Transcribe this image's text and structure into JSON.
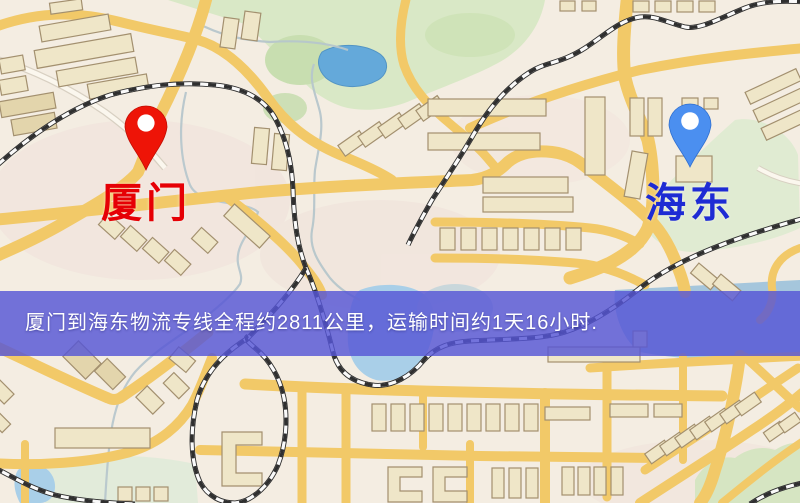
{
  "map": {
    "origin": {
      "label": "厦门",
      "pin_color": "#ee1407",
      "pin_edge": "#c00d02",
      "label_color": "#e60005"
    },
    "destination": {
      "label": "海东",
      "pin_color": "#4b8ff0",
      "pin_edge": "#2f6fd0",
      "label_color": "#1e2bd4"
    },
    "banner": {
      "text": "厦门到海东物流专线全程约2811公里，运输时间约1天16小时.",
      "distance_text": "约2811公里",
      "duration_text": "约1天16小时",
      "background": "#5555d6",
      "text_color": "#ffffff"
    },
    "colors": {
      "map_background": "#f4ede2",
      "road": "#f2c968",
      "building": "#efe6c8",
      "building_outline": "#a3906f",
      "park": "#d9e8c6",
      "water": "#64a9da",
      "water_light": "#a9cfe8",
      "railway": "#2f2f2f"
    }
  }
}
